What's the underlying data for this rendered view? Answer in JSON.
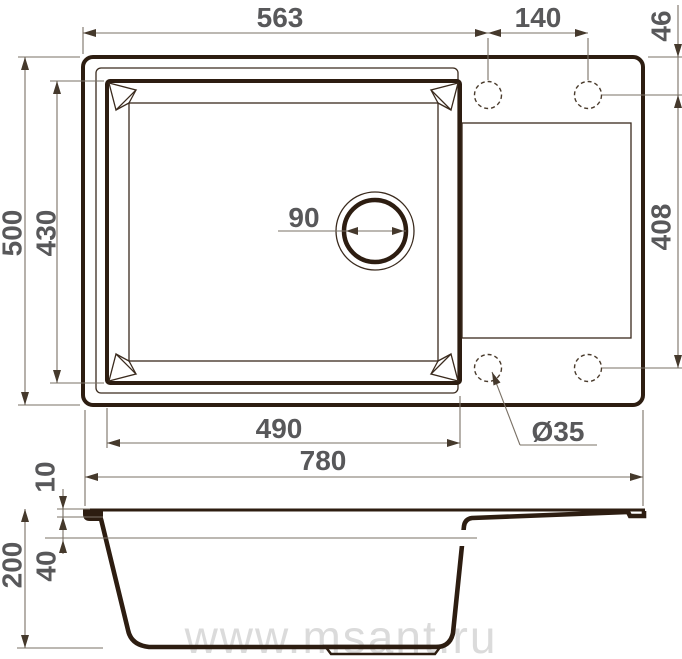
{
  "diagram": {
    "title_hint": "sink-technical-drawing",
    "top_view": {
      "dim_top_width": "563",
      "dim_hole_spacing": "140",
      "dim_hole_offset": "46",
      "dim_overall_depth": "500",
      "dim_bowl_depth": "430",
      "dim_drain": "90",
      "dim_drainboard_depth": "408",
      "dim_bowl_width": "490",
      "dim_hole_diameter": "Ø35",
      "dim_overall_width": "780"
    },
    "section_view": {
      "dim_rim_thickness": "10",
      "dim_rim_to_water": "40",
      "dim_height": "200"
    },
    "watermark": "www.msant.ru"
  }
}
